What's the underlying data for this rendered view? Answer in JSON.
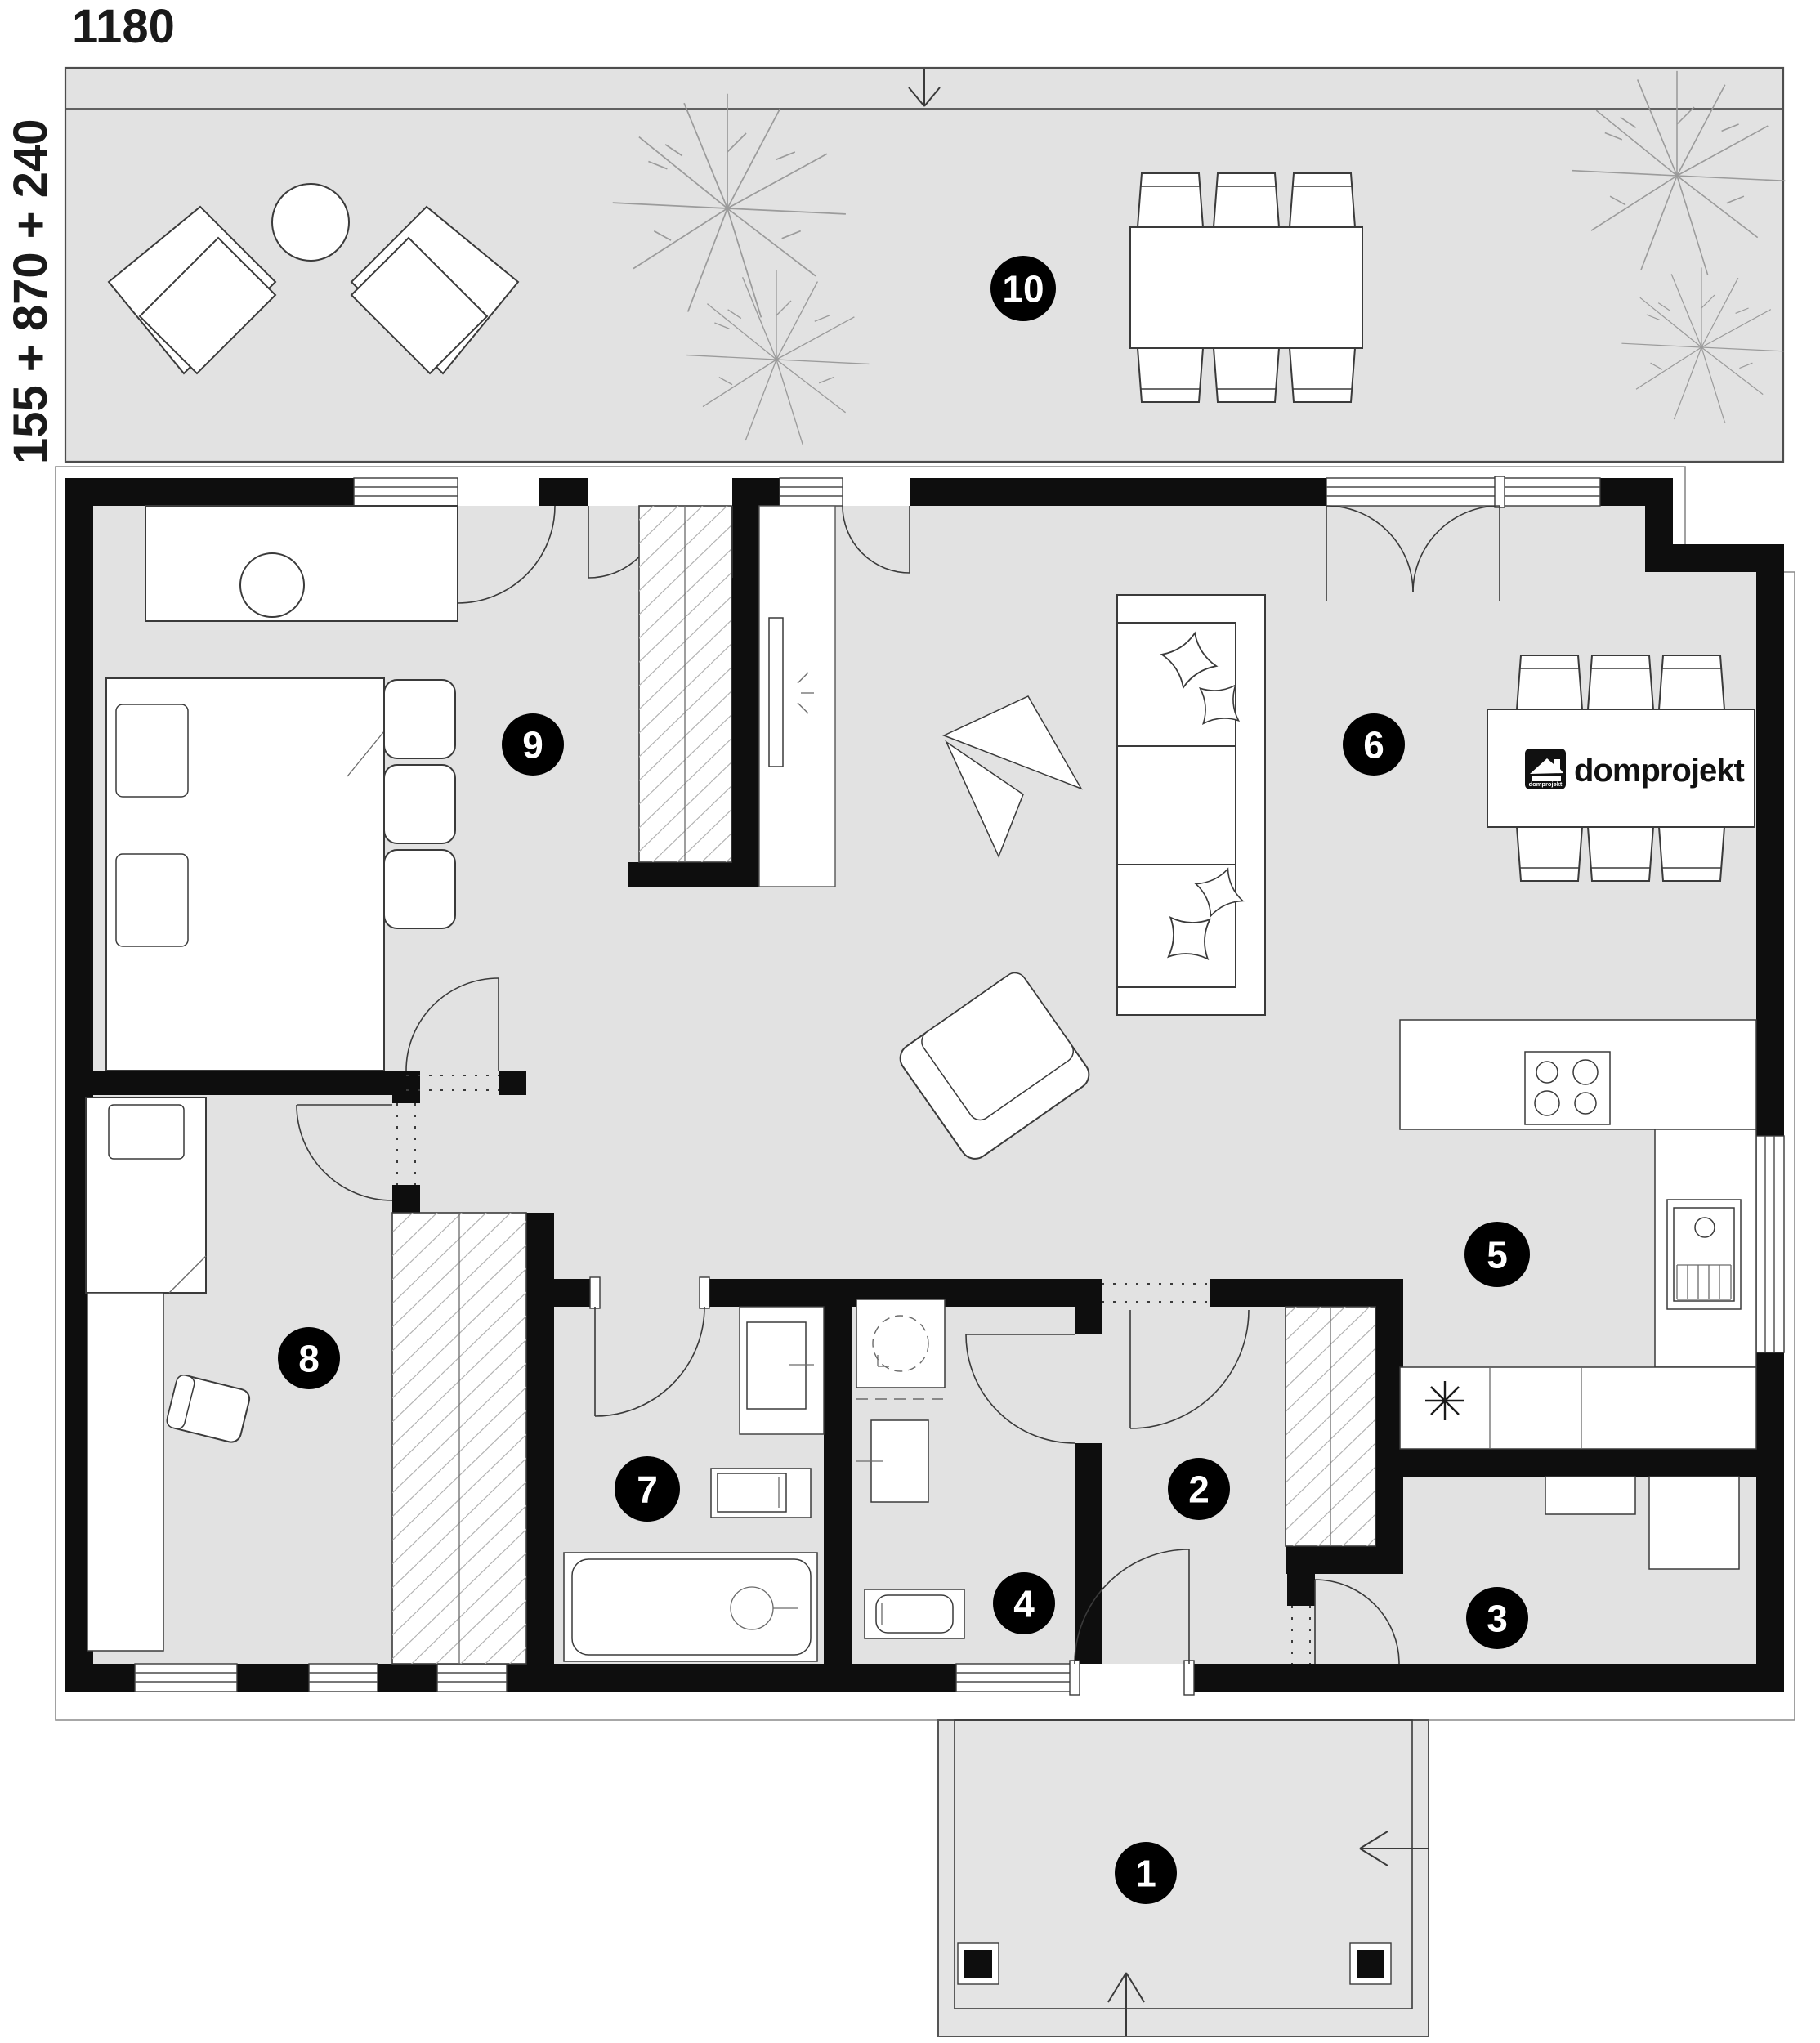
{
  "page": {
    "type": "architectural-floor-plan"
  },
  "dimensions": {
    "top": "1180",
    "left": "155 + 870 + 240"
  },
  "brand": {
    "name": "domprojekt",
    "icon_text": "domprojekt"
  },
  "rooms": [
    {
      "number": "1"
    },
    {
      "number": "2"
    },
    {
      "number": "3"
    },
    {
      "number": "4"
    },
    {
      "number": "5"
    },
    {
      "number": "6"
    },
    {
      "number": "7"
    },
    {
      "number": "8"
    },
    {
      "number": "9"
    },
    {
      "number": "10"
    }
  ],
  "colors": {
    "floor": "#e2e2e2",
    "wall": "#0e0e0e",
    "furniture_line": "#3a3a3a",
    "plant": "#9b9b9b",
    "label_bg": "#000000",
    "label_text": "#ffffff"
  }
}
